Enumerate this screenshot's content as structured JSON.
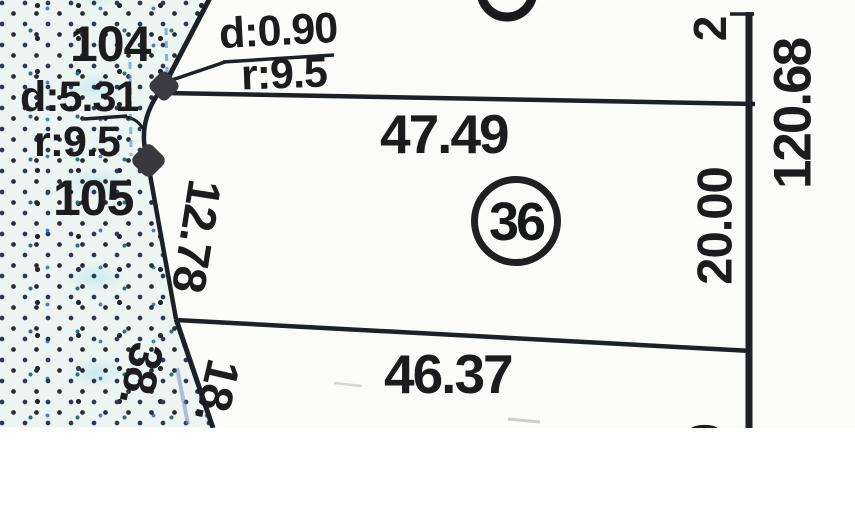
{
  "map": {
    "parcel": {
      "number": "36"
    },
    "dimensions": {
      "front": "47.49",
      "back": "46.37",
      "side_right": "20.00",
      "block_right": "120.68",
      "left_upper": "12.78",
      "adjacent_left": "38.",
      "left_lower": "18.",
      "top_right_partial": "2",
      "bottom_right_partial": "0"
    },
    "survey_points": {
      "p104": "104",
      "p105": "105"
    },
    "curves": {
      "curve1": {
        "d": "d:0.90",
        "r": "r:9.5"
      },
      "curve2": {
        "d": "d:5.31",
        "r": "r:9.5"
      }
    },
    "colors": {
      "ink": "#1c1c1e",
      "paper": "#fbfbf9",
      "water_tint": "#ecf5f2",
      "stipple_dark": "#272c33",
      "stipple_navy": "#2b3a54",
      "stipple_teal": "#2e6f78",
      "stipple_blue": "#4a7fb5",
      "artifact_blue": "#4aa3d8"
    }
  }
}
